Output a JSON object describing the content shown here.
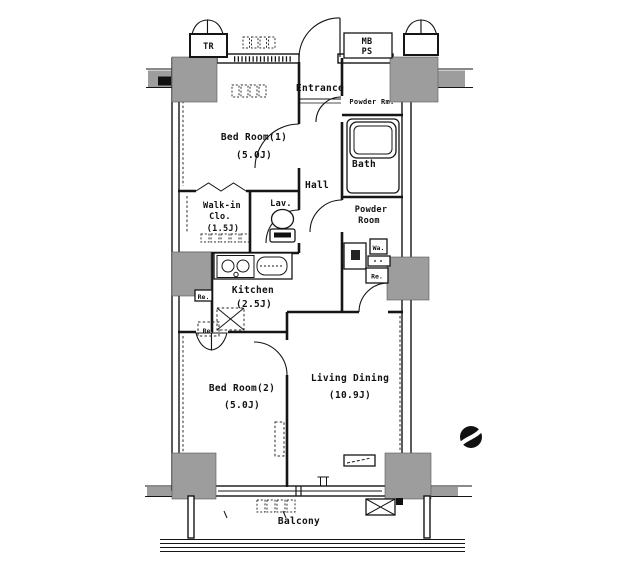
{
  "title": "apartment-floor-plan",
  "rooms": {
    "entrance": {
      "label": "Entrance"
    },
    "hall": {
      "label": "Hall"
    },
    "bed_room_1": {
      "label": "Bed Room(1)",
      "size": "(5.0J)"
    },
    "walk_in_closet": {
      "line1": "Walk-in",
      "line2": "Clo.",
      "size": "(1.5J)"
    },
    "lavatory": {
      "label": "Lav."
    },
    "bath": {
      "label": "Bath"
    },
    "powder_rm": {
      "label": "Powder Rm."
    },
    "powder_room": {
      "line1": "Powder",
      "line2": "Room"
    },
    "kitchen": {
      "label": "Kitchen",
      "size": "(2.5J)"
    },
    "bed_room_2": {
      "label": "Bed Room(2)",
      "size": "(5.0J)"
    },
    "living_dining": {
      "label": "Living Dining",
      "size": "(10.9J)"
    },
    "balcony": {
      "label": "Balcony"
    },
    "trunk_room": {
      "label": "TR"
    },
    "meter_pipe_space": {
      "line1": "MB",
      "line2": "PS"
    }
  },
  "fixtures": {
    "washer": {
      "label": "Wa."
    },
    "refrigerator_a": {
      "label": "Re."
    },
    "refrigerator_b": {
      "label": "Re."
    },
    "refrigerator_c": {
      "label": "Re."
    }
  },
  "colors": {
    "line": "#151515",
    "column_gray": "#9d9d9d",
    "background": "#ffffff"
  }
}
